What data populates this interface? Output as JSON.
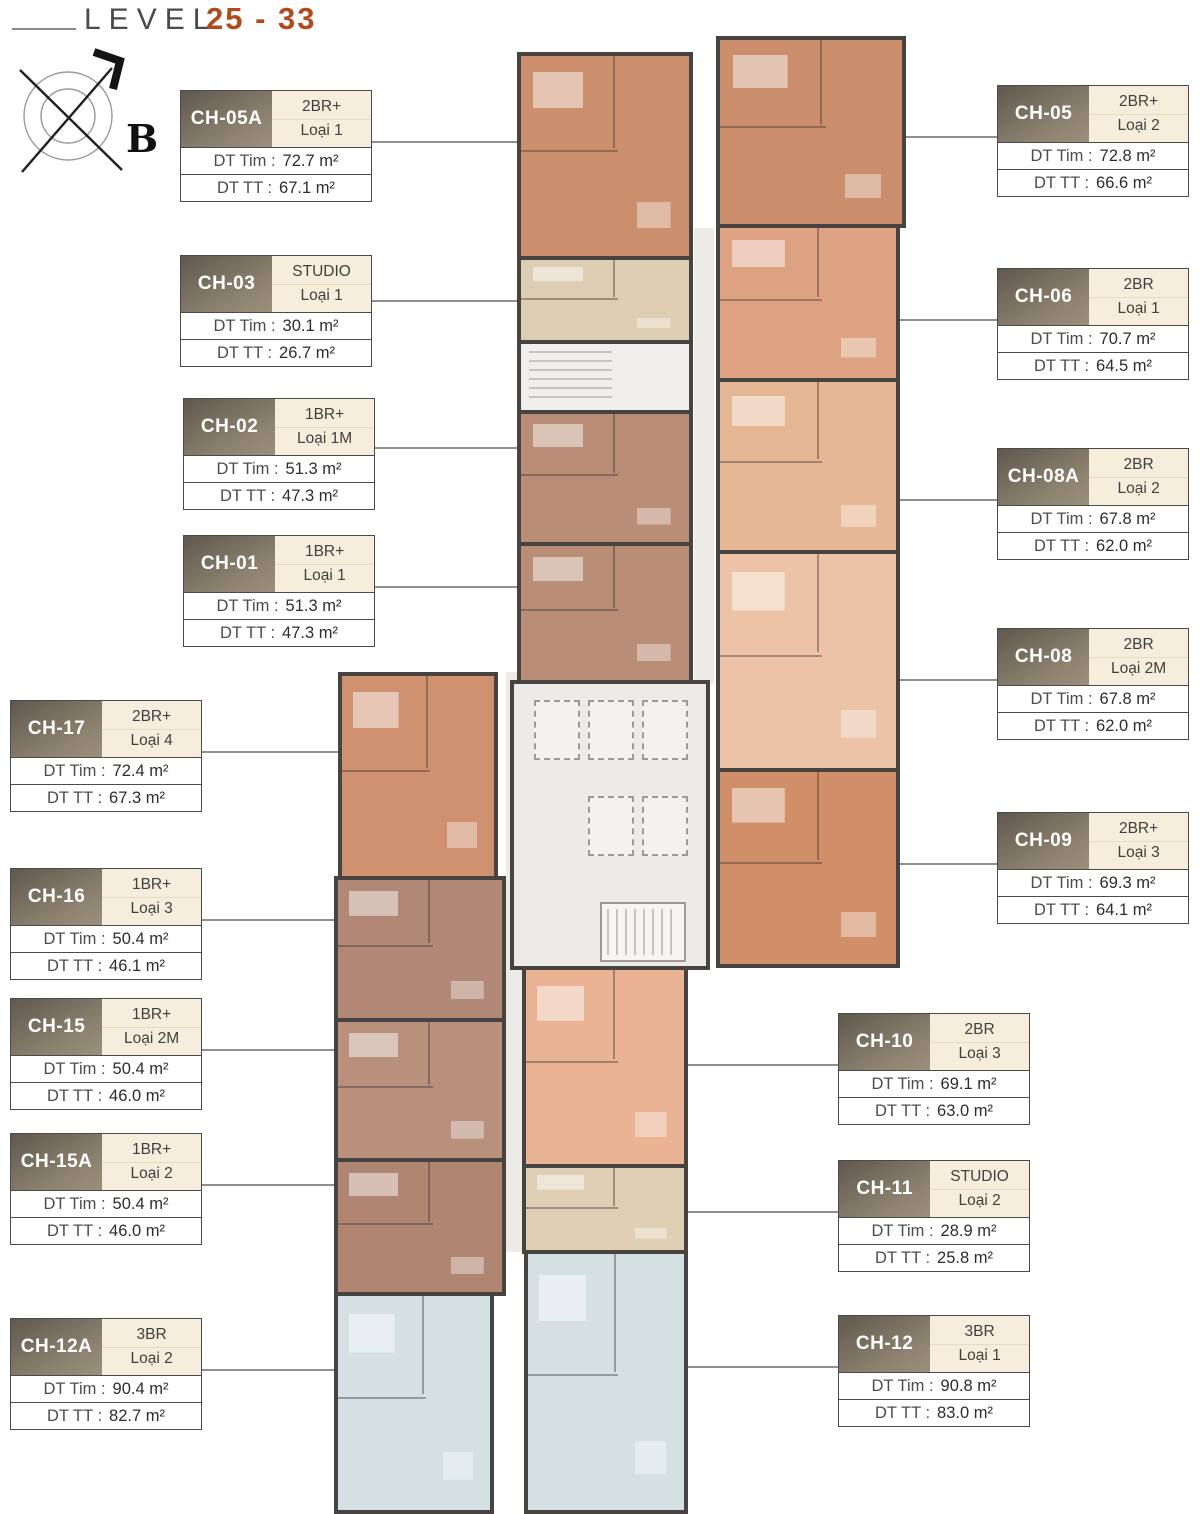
{
  "page": {
    "title_level": "LEVEL",
    "title_range": "25 - 33"
  },
  "compass": {
    "label": "B"
  },
  "labels": {
    "dt_tim": "DT Tim :",
    "dt_tt": "DT TT :"
  },
  "units": [
    {
      "id": "CH-05A",
      "type": "2BR+",
      "variant": "Loại 1",
      "dt_tim": "72.7 m²",
      "dt_tt": "67.1 m²",
      "plan_color": "#cb8f6d"
    },
    {
      "id": "CH-03",
      "type": "STUDIO",
      "variant": "Loại 1",
      "dt_tim": "30.1 m²",
      "dt_tt": "26.7 m²",
      "plan_color": "#dccdb3"
    },
    {
      "id": "CH-02",
      "type": "1BR+",
      "variant": "Loại 1M",
      "dt_tim": "51.3 m²",
      "dt_tt": "47.3 m²",
      "plan_color": "#b98d76"
    },
    {
      "id": "CH-01",
      "type": "1BR+",
      "variant": "Loại 1",
      "dt_tim": "51.3 m²",
      "dt_tt": "47.3 m²",
      "plan_color": "#b98d76"
    },
    {
      "id": "CH-17",
      "type": "2BR+",
      "variant": "Loại 4",
      "dt_tim": "72.4 m²",
      "dt_tt": "67.3 m²",
      "plan_color": "#cf9170"
    },
    {
      "id": "CH-16",
      "type": "1BR+",
      "variant": "Loại 3",
      "dt_tim": "50.4 m²",
      "dt_tt": "46.1 m²",
      "plan_color": "#b18875"
    },
    {
      "id": "CH-15",
      "type": "1BR+",
      "variant": "Loại 2M",
      "dt_tim": "50.4 m²",
      "dt_tt": "46.0 m²",
      "plan_color": "#b8907c"
    },
    {
      "id": "CH-15A",
      "type": "1BR+",
      "variant": "Loại 2",
      "dt_tim": "50.4 m²",
      "dt_tt": "46.0 m²",
      "plan_color": "#b08672"
    },
    {
      "id": "CH-12A",
      "type": "3BR",
      "variant": "Loại 2",
      "dt_tim": "90.4 m²",
      "dt_tt": "82.7 m²",
      "plan_color": "#d5e0e2"
    },
    {
      "id": "CH-05",
      "type": "2BR+",
      "variant": "Loại 2",
      "dt_tim": "72.8 m²",
      "dt_tt": "66.6 m²",
      "plan_color": "#ca8e6c"
    },
    {
      "id": "CH-06",
      "type": "2BR",
      "variant": "Loại 1",
      "dt_tim": "70.7 m²",
      "dt_tt": "64.5 m²",
      "plan_color": "#dda282"
    },
    {
      "id": "CH-08A",
      "type": "2BR",
      "variant": "Loại 2",
      "dt_tim": "67.8 m²",
      "dt_tt": "62.0 m²",
      "plan_color": "#e6b795"
    },
    {
      "id": "CH-08",
      "type": "2BR",
      "variant": "Loại 2M",
      "dt_tim": "67.8 m²",
      "dt_tt": "62.0 m²",
      "plan_color": "#ecc3a6"
    },
    {
      "id": "CH-09",
      "type": "2BR+",
      "variant": "Loại 3",
      "dt_tim": "69.3 m²",
      "dt_tt": "64.1 m²",
      "plan_color": "#d08f68"
    },
    {
      "id": "CH-10",
      "type": "2BR",
      "variant": "Loại 3",
      "dt_tim": "69.1 m²",
      "dt_tt": "63.0 m²",
      "plan_color": "#eab494"
    },
    {
      "id": "CH-11",
      "type": "STUDIO",
      "variant": "Loại 2",
      "dt_tim": "28.9 m²",
      "dt_tt": "25.8 m²",
      "plan_color": "#decfb5"
    },
    {
      "id": "CH-12",
      "type": "3BR",
      "variant": "Loại 1",
      "dt_tim": "90.8 m²",
      "dt_tt": "83.0 m²",
      "plan_color": "#d5e0e2"
    }
  ],
  "colors": {
    "accent_rust": "#b14a1d",
    "title_gray": "#4a4a4a",
    "callout_header_dark": "#60584e",
    "callout_header_light": "#9a8f7b",
    "callout_type_bg": "#f6eddc",
    "wall": "#474340",
    "core_bg": "#edebe7",
    "leader_line": "#8f8f8f",
    "blue_unit": "#d5e0e2",
    "beige_unit": "#dccdb3",
    "mauve_unit": "#b98d76",
    "terracotta_unit": "#cb8f6d"
  }
}
